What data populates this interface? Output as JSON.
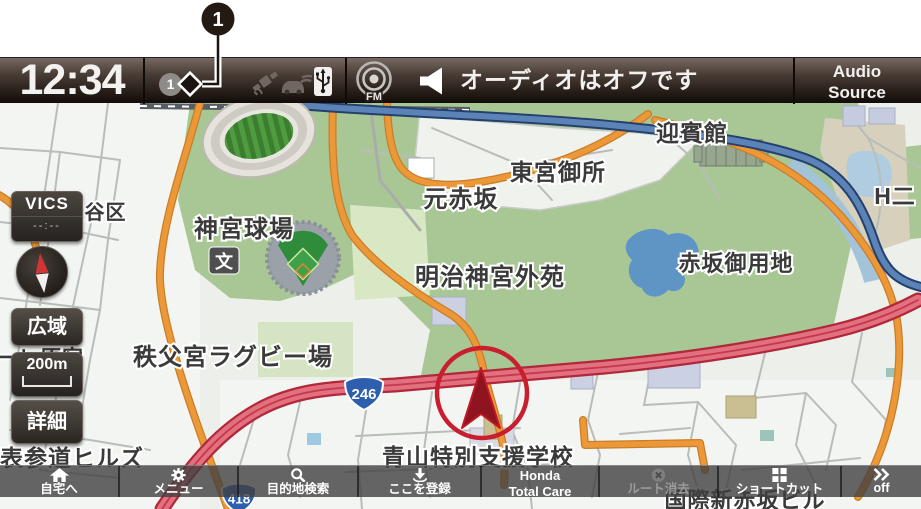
{
  "callout": {
    "number": "1"
  },
  "status_bar": {
    "clock": "12:34",
    "notification_badge": "1",
    "fm_label": "FM",
    "audio_status": "オーディオはオフです",
    "audio_source": {
      "line1": "Audio",
      "line2": "Source"
    },
    "icons": [
      "notification-count",
      "gps-satellite",
      "car-telematics",
      "usb"
    ]
  },
  "map_controls": {
    "vics_label": "VICS",
    "vics_time": "--:--",
    "zoom_out_label": "広域",
    "scale_label": "200m",
    "zoom_in_label": "詳細"
  },
  "map": {
    "labels": [
      {
        "text": "渋谷区"
      },
      {
        "text": "神宮球場"
      },
      {
        "text": "元赤坂"
      },
      {
        "text": "東宮御所"
      },
      {
        "text": "迎賓館"
      },
      {
        "text": "明治神宮外苑"
      },
      {
        "text": "赤坂御用地"
      },
      {
        "text": "H二"
      },
      {
        "text": "秩父宮ラグビー場"
      },
      {
        "text": "ーレ原宿"
      },
      {
        "text": "表参道ヒルズ"
      },
      {
        "text": "青山特別支援学校"
      },
      {
        "text": "国際新赤坂ビル"
      }
    ],
    "school_icon": "文",
    "route_badges": [
      {
        "text": "246"
      },
      {
        "text": "418"
      }
    ]
  },
  "bottom_bar": {
    "items": [
      {
        "label": "自宅へ",
        "icon": "home"
      },
      {
        "label": "メニュー",
        "icon": "gear"
      },
      {
        "label": "目的地検索",
        "icon": "search"
      },
      {
        "label": "ここを登録",
        "icon": "register-location"
      },
      {
        "label": "Honda",
        "label2": "Total Care"
      },
      {
        "label": "ルート消去",
        "icon": "erase-route",
        "disabled": true
      },
      {
        "label": "ショートカット",
        "icon": "shortcut-grid"
      },
      {
        "label": "off",
        "icon": "chevrons"
      }
    ]
  },
  "colors": {
    "top_bar": "#241b16",
    "route_red_fill": "#e2707e",
    "route_red_casing": "#b0283a",
    "road_orange": "#ed9838",
    "highway_blue": "#5b83b8",
    "park_green": "#a8c795",
    "cursor_red": "#c81e2e",
    "badge_blue": "#2e5fae"
  }
}
